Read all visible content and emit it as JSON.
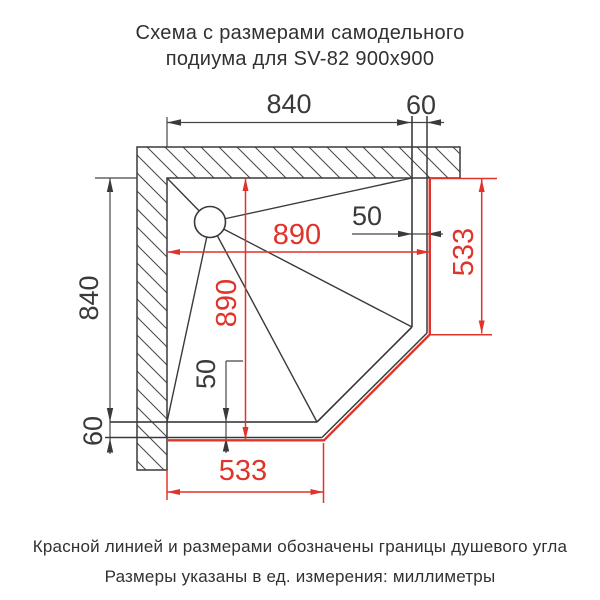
{
  "title": {
    "line1": "Схема с размерами самодельного",
    "line2": "подиума для SV-82 900x900"
  },
  "diagram": {
    "dims": {
      "podium_width": "840",
      "edge_top": "60",
      "podium_depth": "840",
      "edge_left": "60",
      "shower_width": "890",
      "shower_depth": "890",
      "cut_side_right": "533",
      "cut_side_bottom": "533",
      "overhang_right": "50",
      "overhang_bottom": "50"
    },
    "colors": {
      "shower_boundary_red": "#e0342b",
      "drawing_line": "#3a3a3a"
    }
  },
  "footer": {
    "line1": "Красной линией и размерами обозначены границы душевого угла",
    "line2": "Размеры указаны в ед. измерения: миллиметры"
  }
}
